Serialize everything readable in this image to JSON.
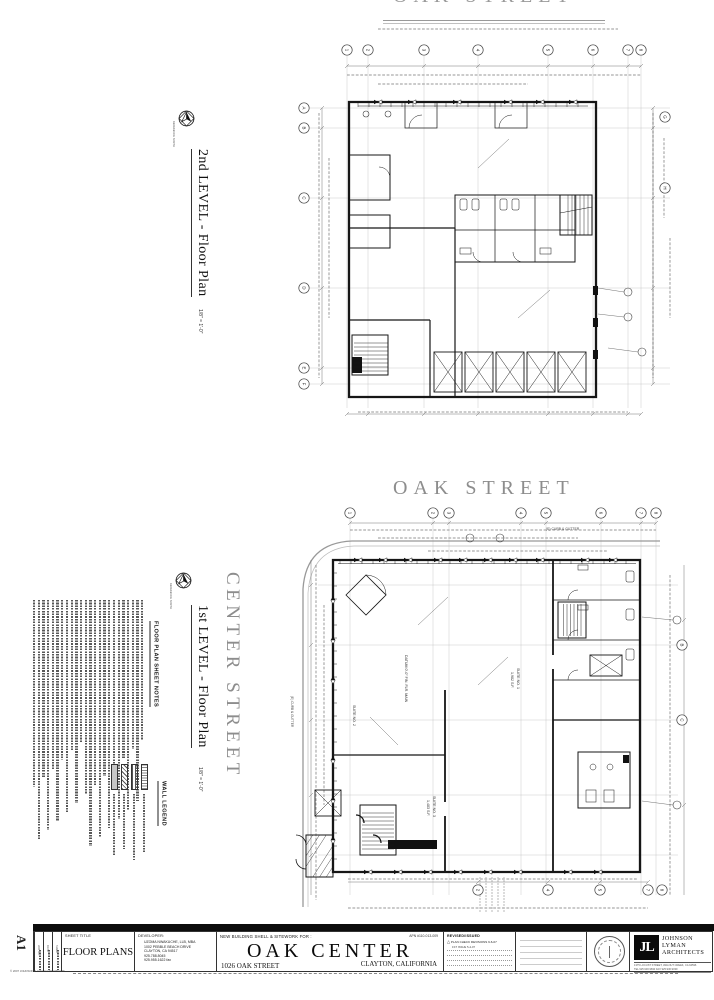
{
  "streets": {
    "top_clipped": "OAK STREET",
    "oak": "OAK STREET",
    "center": "CENTER STREET"
  },
  "plan2": {
    "title": "2nd LEVEL - Floor Plan",
    "scale": "1/8\" = 1'-0\"",
    "north_caption": "REFERENCE NORTH",
    "grid_top": [
      "1",
      "2",
      "3",
      "4",
      "5",
      "6",
      "7",
      "8"
    ],
    "grid_side": [
      "A",
      "B",
      "C",
      "D",
      "E",
      "F"
    ],
    "grid_right": [
      "G",
      "H"
    ]
  },
  "plan1": {
    "title": "1st LEVEL - Floor Plan",
    "scale": "1/8\" = 1'-0\"",
    "north_caption": "REFERENCE NORTH",
    "grid_top": [
      "1",
      "2",
      "3",
      "4",
      "5",
      "6",
      "7",
      "8"
    ],
    "grid_bottom": [
      "2",
      "4",
      "5",
      "7",
      "8"
    ],
    "grid_right": [
      "B",
      "C"
    ],
    "labels": {
      "datum": "DATUM 0'-0\" FIN. FLR. MAIN",
      "suite1": "SUITE NO. 1",
      "suite1_area": "1,982 S.F.",
      "suite2": "SUITE NO. 2",
      "suite3": "SUITE NO. 3",
      "suite3_area": "1,483 S.F.",
      "curb": "(E) CURB & GUTTER"
    }
  },
  "notes_heading": "FLOOR PLAN SHEET NOTES",
  "legend_heading": "WALL LEGEND",
  "titleblock": {
    "sheet_number": "A1",
    "side_labels": [
      "JOB NO.",
      "DATE",
      "SHEET"
    ],
    "sheet_title_label": "SHEET TITLE",
    "sheet_title": "FLOOR PLANS",
    "developer_label": "DEVELOPER:",
    "developer_lines": [
      "UZOMA NWAKUCHE, LLB, MBA",
      "1002 PEBBLE BEACH DRIVE",
      "CLAYTON, CA  94517",
      "925.788.8045",
      "925.955.1622 fax"
    ],
    "project_for": "NEW BUILDING SHELL & SITEWORK FOR :",
    "project_name": "OAK CENTER",
    "project_address": "1026 OAK STREET",
    "project_city": "CLAYTON, CALIFORNIA",
    "apn": "APN #110-013-009",
    "revisions_label": "REVISED/ISSUED",
    "revision_delta": "△",
    "revisions": [
      "PLAN CHECK REVISIONS  9-6-07",
      "1ST ISSUE  5-4-07"
    ],
    "firm": {
      "logo": "JL",
      "name_lines": [
        "JOHNSON",
        "LYMAN",
        "ARCHITECTS"
      ],
      "address": "1375 LOCUST STREET, WALNUT CREEK, CA 94596",
      "phone": "TEL 925.930.9690    FAX 925.930.9039"
    },
    "copyright": "© 2007  JOHNSON & LYMAN ARCHITECTS"
  }
}
